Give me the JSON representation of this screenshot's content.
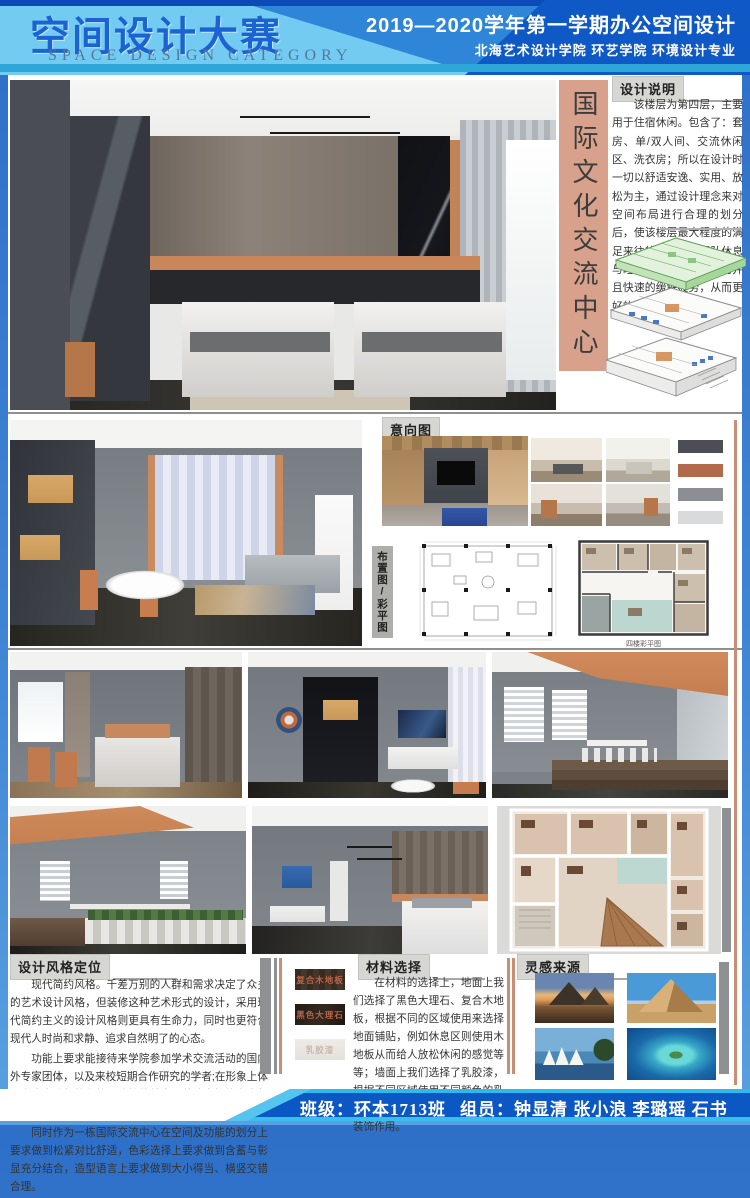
{
  "header": {
    "title": "空间设计大赛",
    "subtitle": "SPACE DESIGN CATEGORY",
    "course": "2019—2020学年第一学期办公空间设计",
    "school": "北海艺术设计学院  环艺学院  环境设计专业"
  },
  "banner": {
    "text": "国际文化交流中心"
  },
  "design_notes": {
    "label": "设计说明",
    "body": "该楼层为第四层，主要用于住宿休闲。包含了：套房、单/双人间、交流休闲区、洗衣房；所以在设计时一切以舒适安逸、实用、放松为主，通过设计理念来对空间布局进行合理的划分后，使该楼层最大程度的满足来往的专家交流团队休息与睡眠需求，使其有效的并且快速的缓解疲劳，从而更好的工作。"
  },
  "moodboard": {
    "label": "意向图",
    "swatches": [
      "#4b4f55",
      "#b26b4a",
      "#8b8e92",
      "#d9dadb"
    ]
  },
  "plans": {
    "label": "布置图/彩平图",
    "caption": "四楼彩平图"
  },
  "style_positioning": {
    "label": "设计风格定位",
    "paragraphs": [
      "现代简约风格。千差万别的人群和需求决定了众多的艺术设计风格，但装修这种艺术形式的设计，采用现代简约主义的设计风格则更具有生命力，同时也更符合现代人时尚和求静、追求自然明了的心态。",
      "功能上要求能接待来学院参加学术交流活动的国内外专家团体，以及来校短期合作研究的学者;在形象上体现学术交流机构和校园建筑的特点，营造良好的学术氛围，摒弃商业化的形象。",
      "同时作为一栋国际交流中心在空间及功能的划分上要求做到松紧对比舒适，色彩选择上要求做到含蓄与彰显充分结合，造型语言上要求做到大小得当、横竖交错合理。"
    ]
  },
  "materials": {
    "label": "材料选择",
    "swatches": [
      "复合木地板",
      "黑色大理石",
      "乳胶漆"
    ],
    "body": "在材料的选择上，地面上我们选择了黑色大理石、复合木地板，根据不同的区域使用来选择地面铺贴，例如休息区则使用木地板从而给人放松休闲的感觉等等；墙面上我们选择了乳胶漆，根据不同区域使用不同颜色的乳胶漆，用于区分空间以及简单的装饰作用。"
  },
  "inspiration": {
    "label": "灵感来源"
  },
  "footer": {
    "class_label": "班级：环本1713班",
    "members_label": "组员：钟显清 张小浪 李璐瑶 石书"
  },
  "colors": {
    "accent_salmon": "#d8a18c",
    "header_blue": "#0f59c6",
    "header_light_blue": "#74cbf2"
  }
}
